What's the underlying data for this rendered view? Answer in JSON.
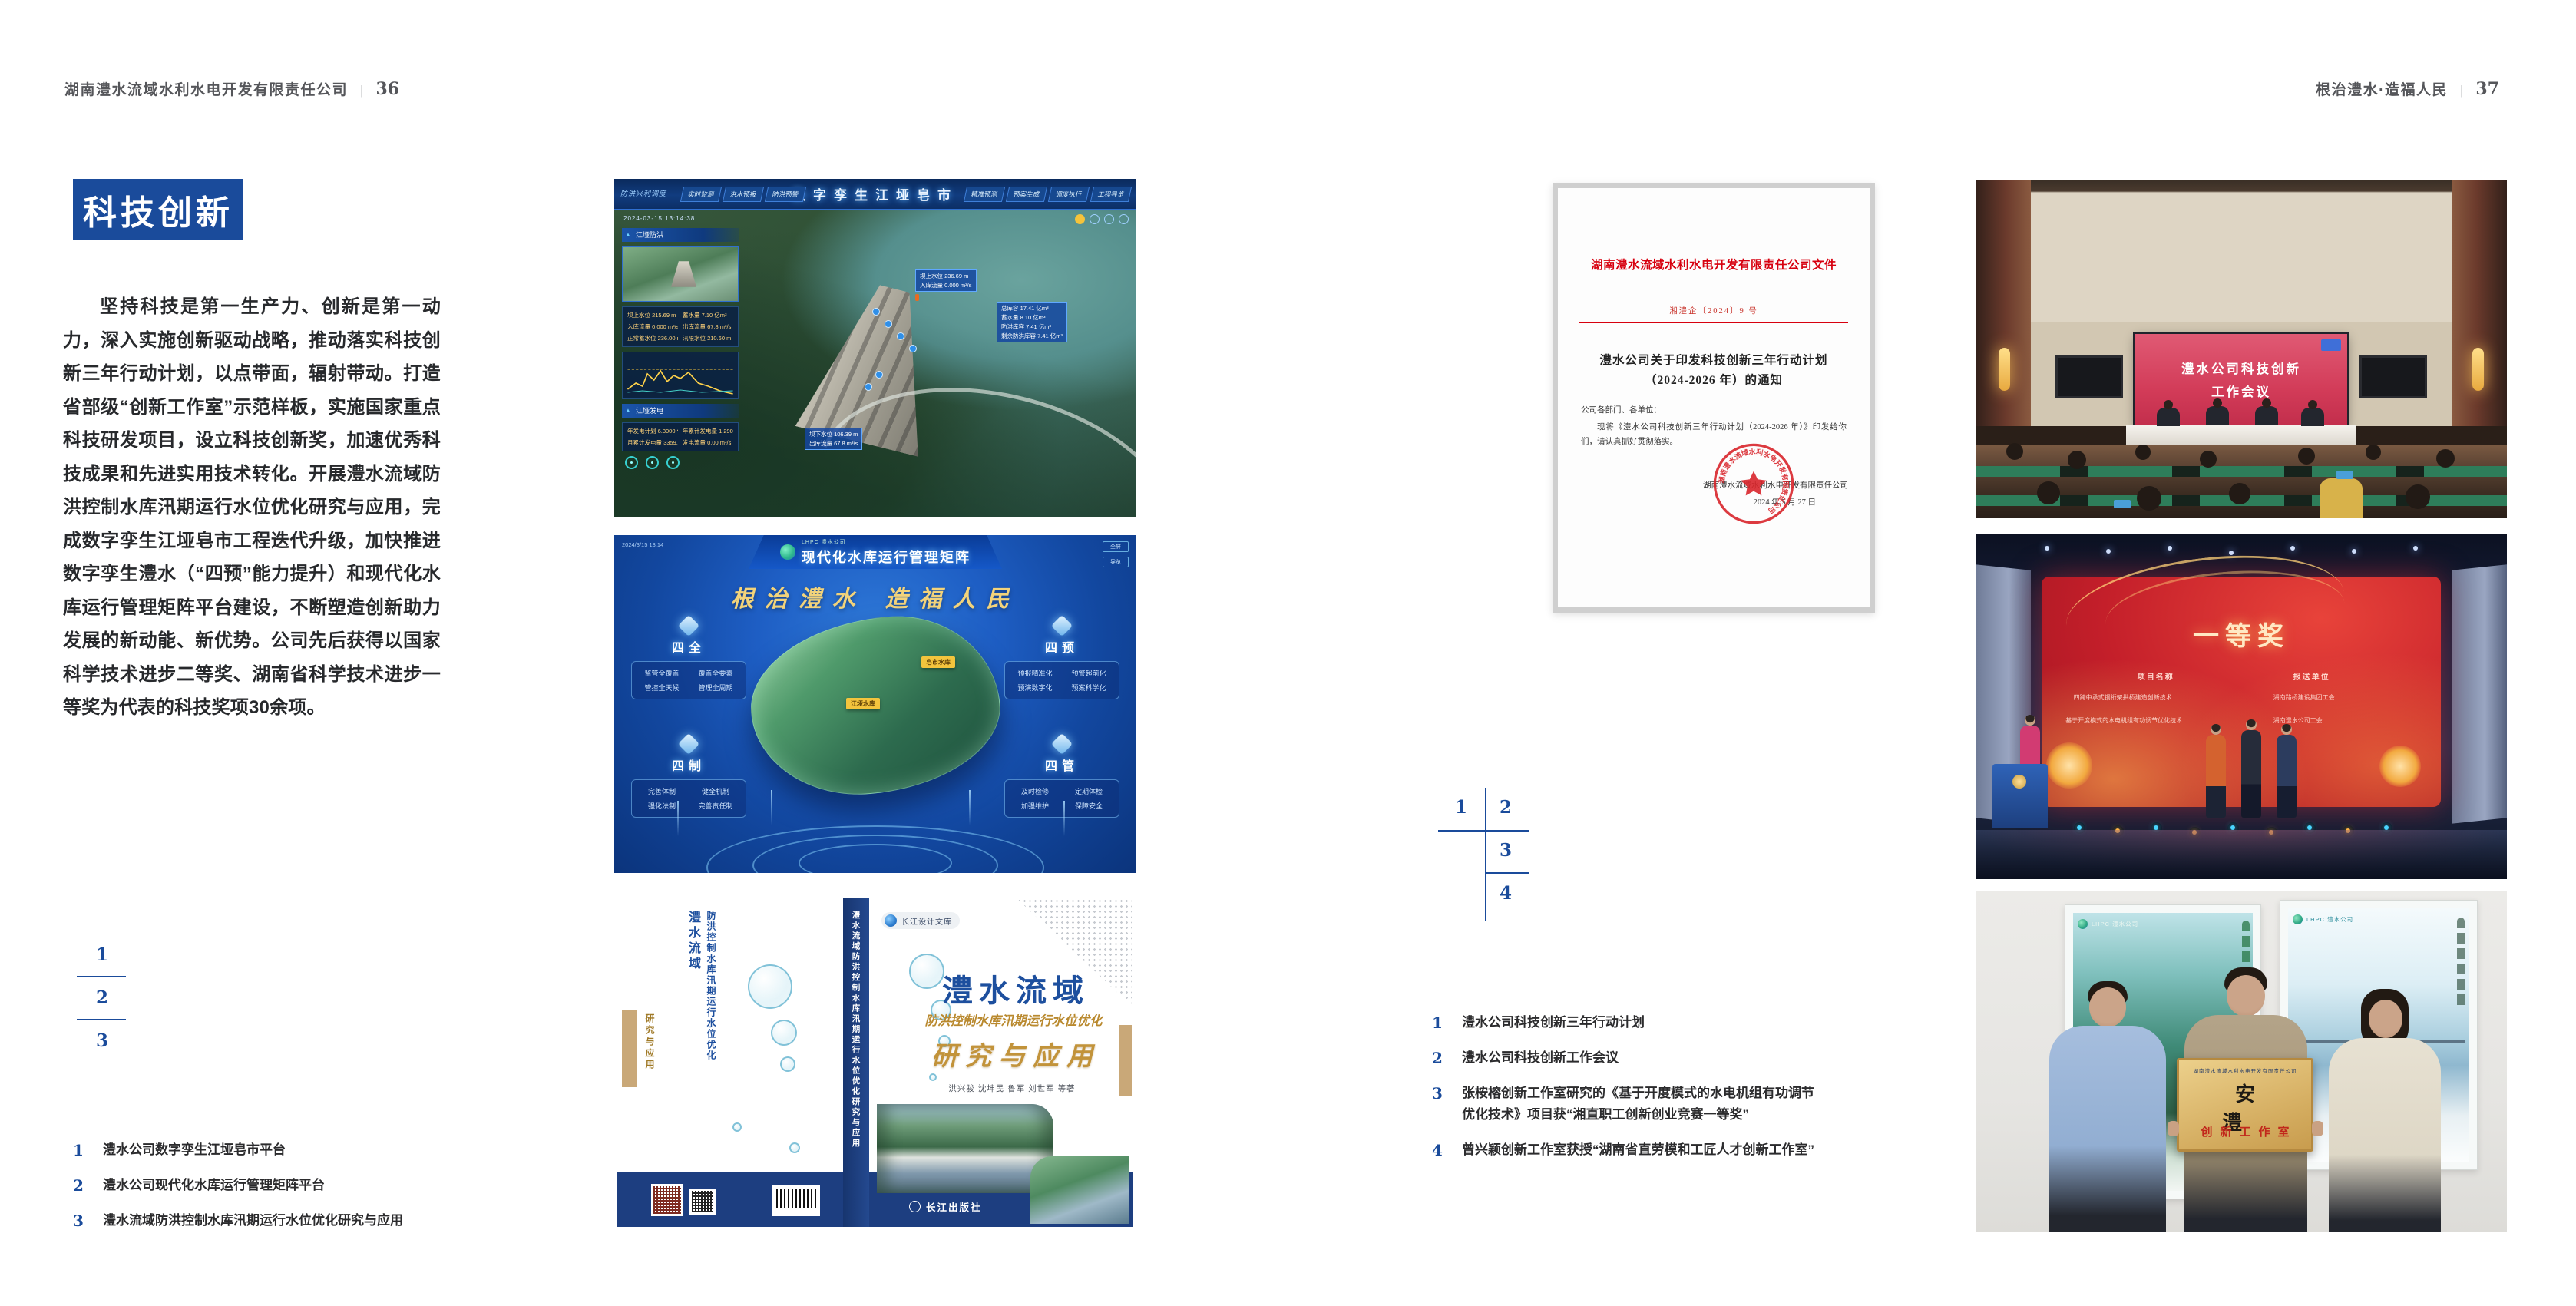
{
  "accent": {
    "blue": "#1a4b9b",
    "doc_red": "#d7000f",
    "gold": "#c2933a"
  },
  "page_left": {
    "header": {
      "company": "湖南澧水流域水利水电开发有限责任公司",
      "divider": "|",
      "page_number": "36"
    },
    "section_title": "科技创新",
    "body": "坚持科技是第一生产力、创新是第一动力，深入实施创新驱动战略，推动落实科技创新三年行动计划，以点带面，辐射带动。打造省部级“创新工作室”示范样板，实施国家重点科技研发项目，设立科技创新奖，加速优秀科技成果和先进实用技术转化。开展澧水流域防洪控制水库汛期运行水位优化研究与应用，完成数字孪生江垭皂市工程迭代升级，加快推进数字孪生澧水（“四预”能力提升）和现代化水库运行管理矩阵平台建设，不断塑造创新助力发展的新动能、新优势。公司先后获得以国家科学技术进步二等奖、湖南省科学技术进步一等奖为代表的科技奖项30余项。",
    "figure_index": {
      "n1": "1",
      "n2": "2",
      "n3": "3"
    },
    "captions": [
      {
        "num": "1",
        "text": "澧水公司数字孪生江垭皂市平台"
      },
      {
        "num": "2",
        "text": "澧水公司现代化水库运行管理矩阵平台"
      },
      {
        "num": "3",
        "text": "澧水流域防洪控制水库汛期运行水位优化研究与应用"
      }
    ]
  },
  "page_right": {
    "header": {
      "slogan": "根治澧水·造福人民",
      "divider": "|",
      "page_number": "37"
    },
    "figure_index": {
      "n1": "1",
      "n2": "2",
      "n3": "3",
      "n4": "4"
    },
    "captions": [
      {
        "num": "1",
        "text": "澧水公司科技创新三年行动计划"
      },
      {
        "num": "2",
        "text": "澧水公司科技创新工作会议"
      },
      {
        "num": "3",
        "text": "张桉榕创新工作室研究的《基于开度模式的水电机组有功调节优化技术》项目获“湘直职工创新创业竞赛一等奖”"
      },
      {
        "num": "4",
        "text": "曾兴颖创新工作室获授“湖南省直劳模和工匠人才创新工作室”"
      }
    ]
  },
  "figure_digital_twin": {
    "title": "数字孪生江垭皂市",
    "corner_label": "防洪兴利调度",
    "tabs_left": [
      "实时监测",
      "洪水预报",
      "防洪预警"
    ],
    "tabs_right": [
      "精准预测",
      "预案生成",
      "调度执行",
      "工程导览"
    ],
    "timestamp": "2024-03-15 13:14:38",
    "panel_flood_title": "江垭防洪",
    "flood_rows": [
      "坝上水位 215.69 m",
      "蓄水量 7.10 亿m³",
      "入库流量 0.000 m³/s",
      "出库流量 67.8 m³/s",
      "正常蓄水位 236.00 m",
      "汛限水位 210.60 m"
    ],
    "panel_power_title": "江垭发电",
    "power_rows": [
      "年发电计划 6.3000 亿kWh",
      "年累计发电量 1.2907 亿kWh",
      "月累计发电量 3359.21 万kWh",
      "发电流量 0.00 m³/s"
    ],
    "tag_a": [
      "坝上水位 236.69 m",
      "入库流量 0.000 m³/s"
    ],
    "tag_b": [
      "总库容 17.41 亿m³",
      "蓄水量 8.10 亿m³",
      "防洪库容 7.41 亿m³",
      "剩余防洪库容 7.41 亿m³"
    ],
    "tag_c": [
      "坝下水位 106.39 m",
      "出库流量 67.8 m³/s"
    ]
  },
  "figure_matrix": {
    "logo_text": "LHPC 澧水公司",
    "title": "现代化水库运行管理矩阵",
    "timestamp": "2024/3/15 13:14",
    "btn1": "全屏",
    "btn2": "导览",
    "slogan": "根治澧水 造福人民",
    "groups": [
      {
        "label": "四全",
        "items": [
          "监管全覆盖",
          "覆盖全要素",
          "管控全天候",
          "管理全周期"
        ]
      },
      {
        "label": "四预",
        "items": [
          "预报精准化",
          "预警超前化",
          "预演数字化",
          "预案科学化"
        ]
      },
      {
        "label": "四制",
        "items": [
          "完善体制",
          "健全机制",
          "强化法制",
          "完善责任制"
        ]
      },
      {
        "label": "四管",
        "items": [
          "及时检修",
          "定期体检",
          "加强维护",
          "保障安全"
        ]
      }
    ],
    "map_tag1": "皂市水库",
    "map_tag2": "江垭水库"
  },
  "figure_book": {
    "series": "长江设计文库",
    "title_region": "澧水流域",
    "subtitle": "防洪控制水库汛期运行水位优化",
    "title2": "研究与应用",
    "authors": "洪兴骏 沈坤民 鲁军 刘世军 等著",
    "publisher": "长江出版社",
    "spine_text": "澧水流域防洪控制水库汛期运行水位优化研究与应用",
    "back_title1": "澧水流域",
    "back_title2": "防洪控制水库汛期运行水位优化",
    "back_title3": "研究与应用"
  },
  "figure_document": {
    "headline": "湖南澧水流域水利水电开发有限责任公司文件",
    "doc_no": "湘澧企〔2024〕9 号",
    "title_line1": "澧水公司关于印发科技创新三年行动计划",
    "title_line2": "（2024-2026 年）的通知",
    "salutation": "公司各部门、各单位：",
    "body": "现将《澧水公司科技创新三年行动计划（2024-2026 年）》印发给你们，请认真抓好贯彻落实。",
    "signer": "湖南澧水流域水利水电开发有限责任公司",
    "date": "2024 年 5 月 27 日",
    "stamp_text": "湖南澧水流域水利水电开发有限责任公司"
  },
  "figure_meeting": {
    "screen_line1": "澧水公司科技创新",
    "screen_line2": "工作会议"
  },
  "figure_award": {
    "screen_title": "一等奖",
    "col1": "项目名称",
    "col2": "报送单位",
    "row1_project": "四跨中承式钢桁架拱桥建造创新技术",
    "row1_org": "湖南路桥建设集团工会",
    "row2_project": "基于开度模式的水电机组有功调节优化技术",
    "row2_org": "湖南澧水公司工会"
  },
  "figure_group": {
    "plaque_header": "湖南澧水流域水利水电开发有限责任公司",
    "plaque_title": "安 澧",
    "plaque_subtitle": "创新工作室",
    "poster1_logo": "LHPC 澧水公司",
    "poster2_logo": "LHPC 澧水公司"
  }
}
